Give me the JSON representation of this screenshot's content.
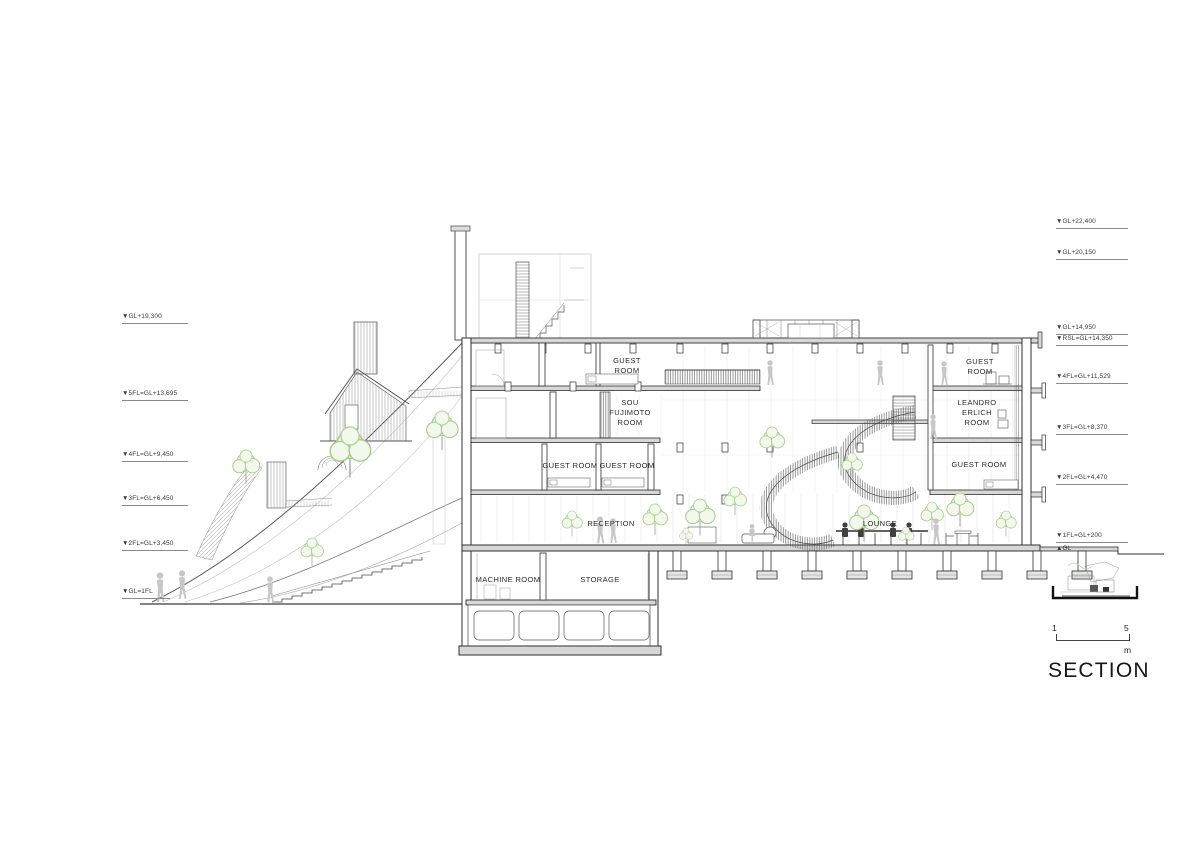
{
  "title": "SECTION",
  "scale_bar": {
    "start": "1",
    "end": "5",
    "unit": "m"
  },
  "levels": {
    "left": [
      {
        "label": "▼GL+19,300"
      },
      {
        "label": "▼5FL=GL+13,695"
      },
      {
        "label": "▼4FL=GL+9,450"
      },
      {
        "label": "▼3FL=GL+6,450"
      },
      {
        "label": "▼2FL=GL+3,450"
      },
      {
        "label": "▼GL=1FL"
      }
    ],
    "right": [
      {
        "label": "▼GL+22,400"
      },
      {
        "label": "▼GL+20,150"
      },
      {
        "label": "▼GL+14,950"
      },
      {
        "label": "▼RSL=GL+14,350"
      },
      {
        "label": "▼4FL=GL+11,529"
      },
      {
        "label": "▼3FL=GL+8,370"
      },
      {
        "label": "▼2FL=GL+4,470"
      },
      {
        "label": "▼1FL=GL+200"
      },
      {
        "label": "▲GL"
      }
    ]
  },
  "rooms": {
    "guest_room_top": "GUEST ROOM",
    "sou_fujimoto_room": "SOU FUJIMOTO ROOM",
    "guest_room_3f_left": "GUEST ROOM",
    "guest_room_3f_right": "GUEST ROOM",
    "reception": "RECEPTION",
    "lounge": "LOUNGE",
    "machine_room": "MACHINE ROOM",
    "storage": "STORAGE",
    "guest_room_right_top": "GUEST ROOM",
    "leandro_erlich_room": "LEANDRO ERLICH ROOM",
    "guest_room_right_lower": "GUEST ROOM"
  },
  "colors": {
    "paper": "#ffffff",
    "ink": "#2f2f2f",
    "light_line": "#c9c9c9",
    "slab_fill": "#d7d7d7",
    "foliage": "#a8cb8d",
    "figure": "#c7c7c7"
  }
}
